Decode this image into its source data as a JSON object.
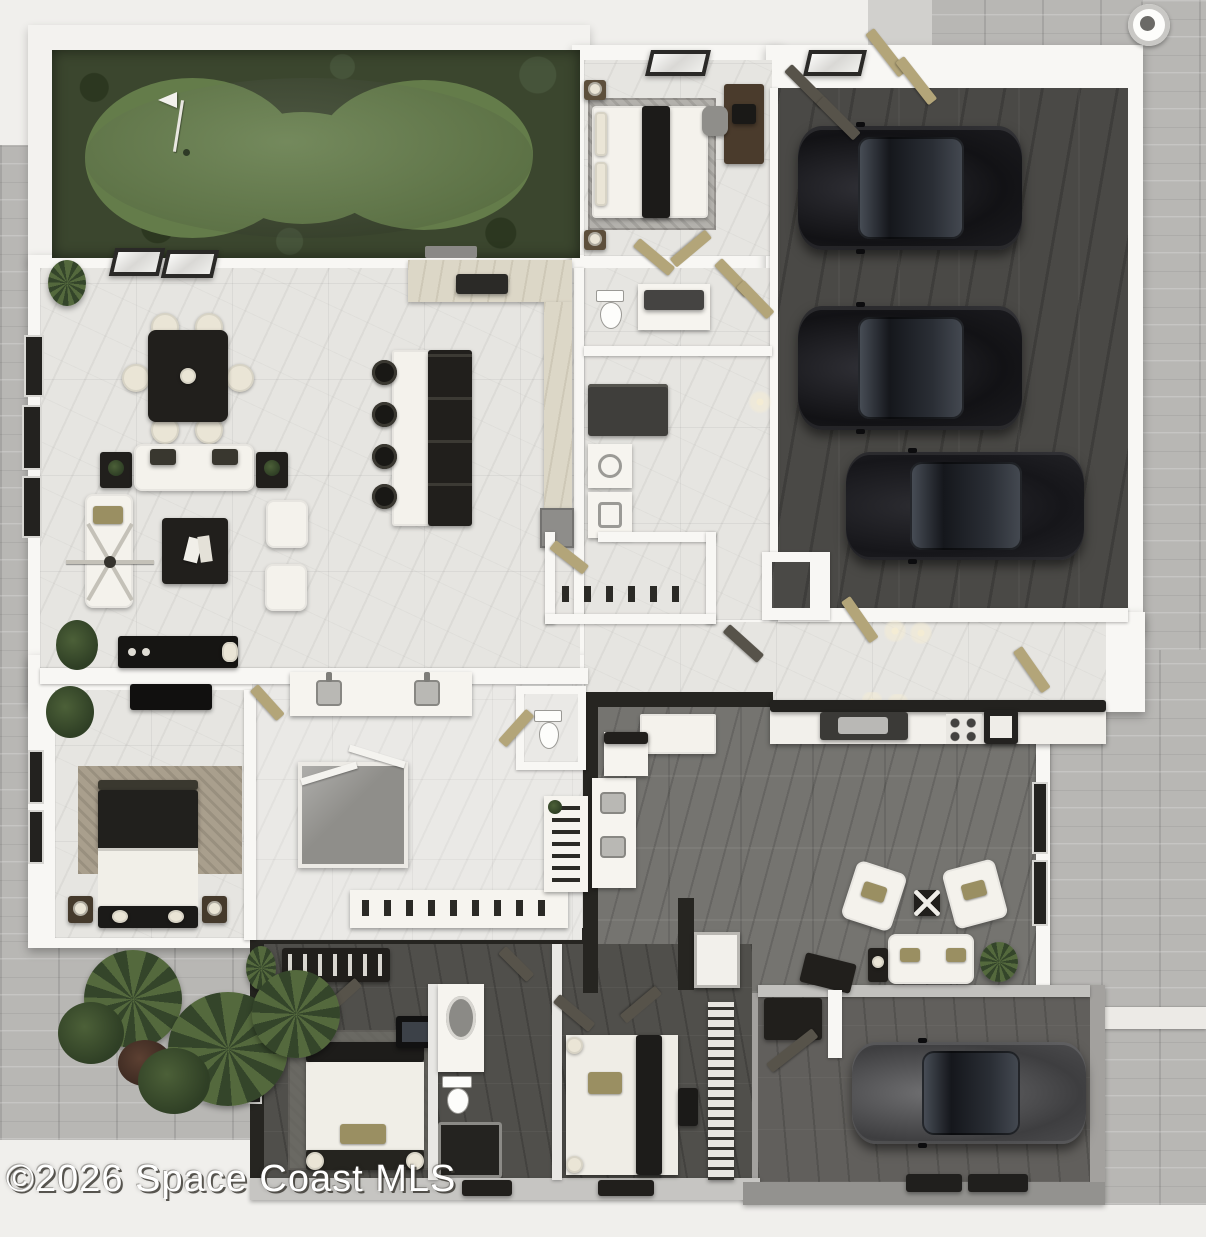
{
  "watermark": {
    "text": "©2026 Space Coast MLS"
  },
  "palette": {
    "bg": "#f0efec",
    "wall": "#f8f7f4",
    "deck": "#f3f2ef",
    "floorlight": "#e6e5e1",
    "floorbath": "#eae9e6",
    "floormid": "#757470",
    "floordark": "#4a4946",
    "floorwing": "#504f4b",
    "floorg2": "#615f5c",
    "paver": "#b8b7b4",
    "concrete": "#d1d0cd",
    "green": "#647c4a",
    "mulch": "#3b462e",
    "blackfurn": "#211f1c",
    "cream": "#eae5d6",
    "tan": "#b3a579",
    "carblack": "#141417",
    "cargray": "#565658",
    "watermark_color": "#ffffff"
  },
  "scene": {
    "areas": [
      "putting-green",
      "deck",
      "great-room",
      "dining-area",
      "living-area",
      "kitchen",
      "guest-bedroom",
      "guest-bathroom",
      "laundry",
      "walk-in-pantry",
      "three-car-garage",
      "entry-hall",
      "master-bedroom",
      "master-bathroom",
      "walk-in-closet",
      "bonus-room",
      "kitchenette-bar",
      "bedroom-three",
      "bedroom-four",
      "shared-bathroom",
      "single-car-garage",
      "paver-driveway",
      "palm-landscaping"
    ],
    "vehicles": [
      "black-suv",
      "black-suv",
      "black-sedan",
      "gray-coupe"
    ],
    "amenities": [
      "golf-flag",
      "skylights",
      "ceiling-fan",
      "dual-sink-vanity",
      "glass-shower",
      "shoe-shelf"
    ]
  }
}
